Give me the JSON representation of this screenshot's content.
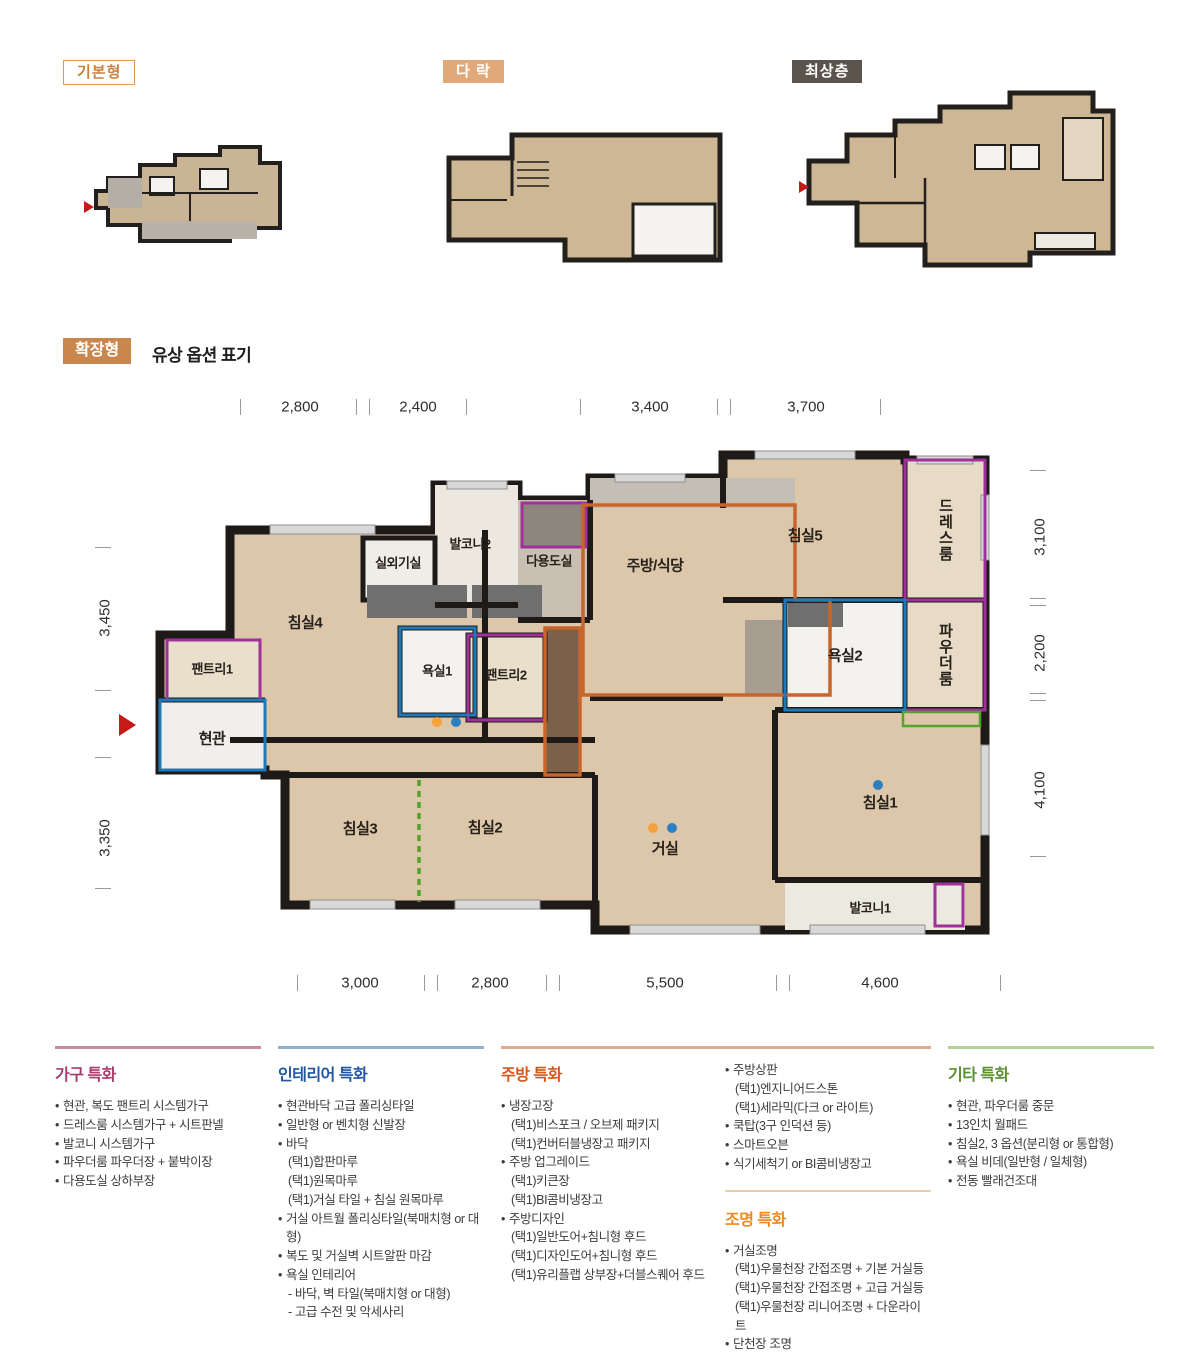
{
  "mini_plans": {
    "basic": {
      "label": "기본형"
    },
    "attic": {
      "label": "다 락"
    },
    "top_floor": {
      "label": "최상층"
    }
  },
  "section_header": {
    "badge": "확장형",
    "title": "유상 옵션 표기"
  },
  "floorplan": {
    "dims_top": [
      "2,800",
      "2,400",
      "3,400",
      "3,700"
    ],
    "dims_bottom": [
      "3,000",
      "2,800",
      "5,500",
      "4,600"
    ],
    "dims_left": [
      "3,450",
      "3,350"
    ],
    "dims_right": [
      "3,100",
      "2,200",
      "4,100"
    ],
    "rooms": {
      "bedroom4": "침실4",
      "outdoor_unit": "실외기실",
      "balcony2": "발코니2",
      "utility": "다용도실",
      "kitchen_dining": "주방/식당",
      "bedroom5": "침실5",
      "dress_room": "드레스룸",
      "pantry1": "팬트리1",
      "bath1": "욕실1",
      "pantry2": "팬트리2",
      "entrance": "현관",
      "bath2": "욕실2",
      "powder_room": "파우더룸",
      "bedroom3": "침실3",
      "bedroom2": "침실2",
      "living": "거실",
      "bedroom1": "침실1",
      "balcony1": "발코니1"
    },
    "option_colors": {
      "purple": "#a0309a",
      "orange": "#c8652a",
      "blue": "#1f78b8",
      "green": "#54a32c",
      "dot_orange": "#f5a23c",
      "dot_blue": "#2e7fc1"
    }
  },
  "features": {
    "columns": [
      {
        "id": "furniture",
        "title": "가구 특화",
        "accent": "#a63d6f",
        "line": "#c9899f",
        "items": [
          {
            "text": "현관, 복도 팬트리 시스템가구",
            "sub": false
          },
          {
            "text": "드레스룸 시스템가구 + 시트판넬",
            "sub": false
          },
          {
            "text": "발코니 시스템가구",
            "sub": false
          },
          {
            "text": "파우더룸 파우더장 + 붙박이장",
            "sub": false
          },
          {
            "text": "다용도실 상하부장",
            "sub": false
          }
        ]
      },
      {
        "id": "interior",
        "title": "인테리어 특화",
        "accent": "#2456a0",
        "line": "#93afce",
        "items": [
          {
            "text": "현관바닥 고급 폴리싱타일",
            "sub": false
          },
          {
            "text": "일반형 or 벤치형 신발장",
            "sub": false
          },
          {
            "text": "바닥",
            "sub": false
          },
          {
            "text": "(택1)합판마루",
            "sub": true
          },
          {
            "text": "(택1)원목마루",
            "sub": true
          },
          {
            "text": "(택1)거실 타일 + 침실 원목마루",
            "sub": true
          },
          {
            "text": "거실 아트월 폴리싱타일(북매치형 or 대형)",
            "sub": false
          },
          {
            "text": "복도 및 거실벽 시트알판 마감",
            "sub": false
          },
          {
            "text": "욕실 인테리어",
            "sub": false
          },
          {
            "text": "- 바닥, 벽 타일(북매치형 or 대형)",
            "sub": true
          },
          {
            "text": "- 고급 수전 및 악세사리",
            "sub": true
          }
        ]
      },
      {
        "id": "kitchen",
        "title": "주방 특화",
        "accent": "#d4581d",
        "line": "#dcae91",
        "items": [
          {
            "text": "냉장고장",
            "sub": false
          },
          {
            "text": "(택1)비스포크 / 오브제 패키지",
            "sub": true
          },
          {
            "text": "(택1)컨버터블냉장고 패키지",
            "sub": true
          },
          {
            "text": "주방 업그레이드",
            "sub": false
          },
          {
            "text": "(택1)키큰장",
            "sub": true
          },
          {
            "text": "(택1)BI콤비냉장고",
            "sub": true
          },
          {
            "text": "주방디자인",
            "sub": false
          },
          {
            "text": "(택1)일반도어+침니형 후드",
            "sub": true
          },
          {
            "text": "(택1)디자인도어+침니형 후드",
            "sub": true
          },
          {
            "text": "(택1)유리플랩 상부장+더블스퀘어 후드",
            "sub": true
          }
        ]
      },
      {
        "id": "kitchen_cont",
        "title": "",
        "items": [
          {
            "text": "주방상판",
            "sub": false
          },
          {
            "text": "(택1)엔지니어드스톤",
            "sub": true
          },
          {
            "text": "(택1)세라믹(다크 or 라이트)",
            "sub": true
          },
          {
            "text": "쿡탑(3구 인덕션 등)",
            "sub": false
          },
          {
            "text": "스마트오븐",
            "sub": false
          },
          {
            "text": "식기세척기 or BI콤비냉장고",
            "sub": false
          }
        ],
        "subsection": {
          "title": "조명 특화",
          "accent": "#ee8a22",
          "items": [
            {
              "text": "거실조명",
              "sub": false
            },
            {
              "text": "(택1)우물천장 간접조명 + 기본 거실등",
              "sub": true
            },
            {
              "text": "(택1)우물천장 간접조명 + 고급 거실등",
              "sub": true
            },
            {
              "text": "(택1)우물천장 리니어조명 + 다운라이트",
              "sub": true
            },
            {
              "text": "단천장 조명",
              "sub": false
            }
          ]
        }
      },
      {
        "id": "etc",
        "title": "기타 특화",
        "accent": "#5a8f33",
        "line": "#b6cf97",
        "items": [
          {
            "text": "현관, 파우더룸 중문",
            "sub": false
          },
          {
            "text": "13인치 월패드",
            "sub": false
          },
          {
            "text": "침실2, 3 옵션(분리형 or 통합형)",
            "sub": false
          },
          {
            "text": "욕실 비데(일반형 / 일체형)",
            "sub": false
          },
          {
            "text": "전동 빨래건조대",
            "sub": false
          }
        ]
      }
    ]
  }
}
